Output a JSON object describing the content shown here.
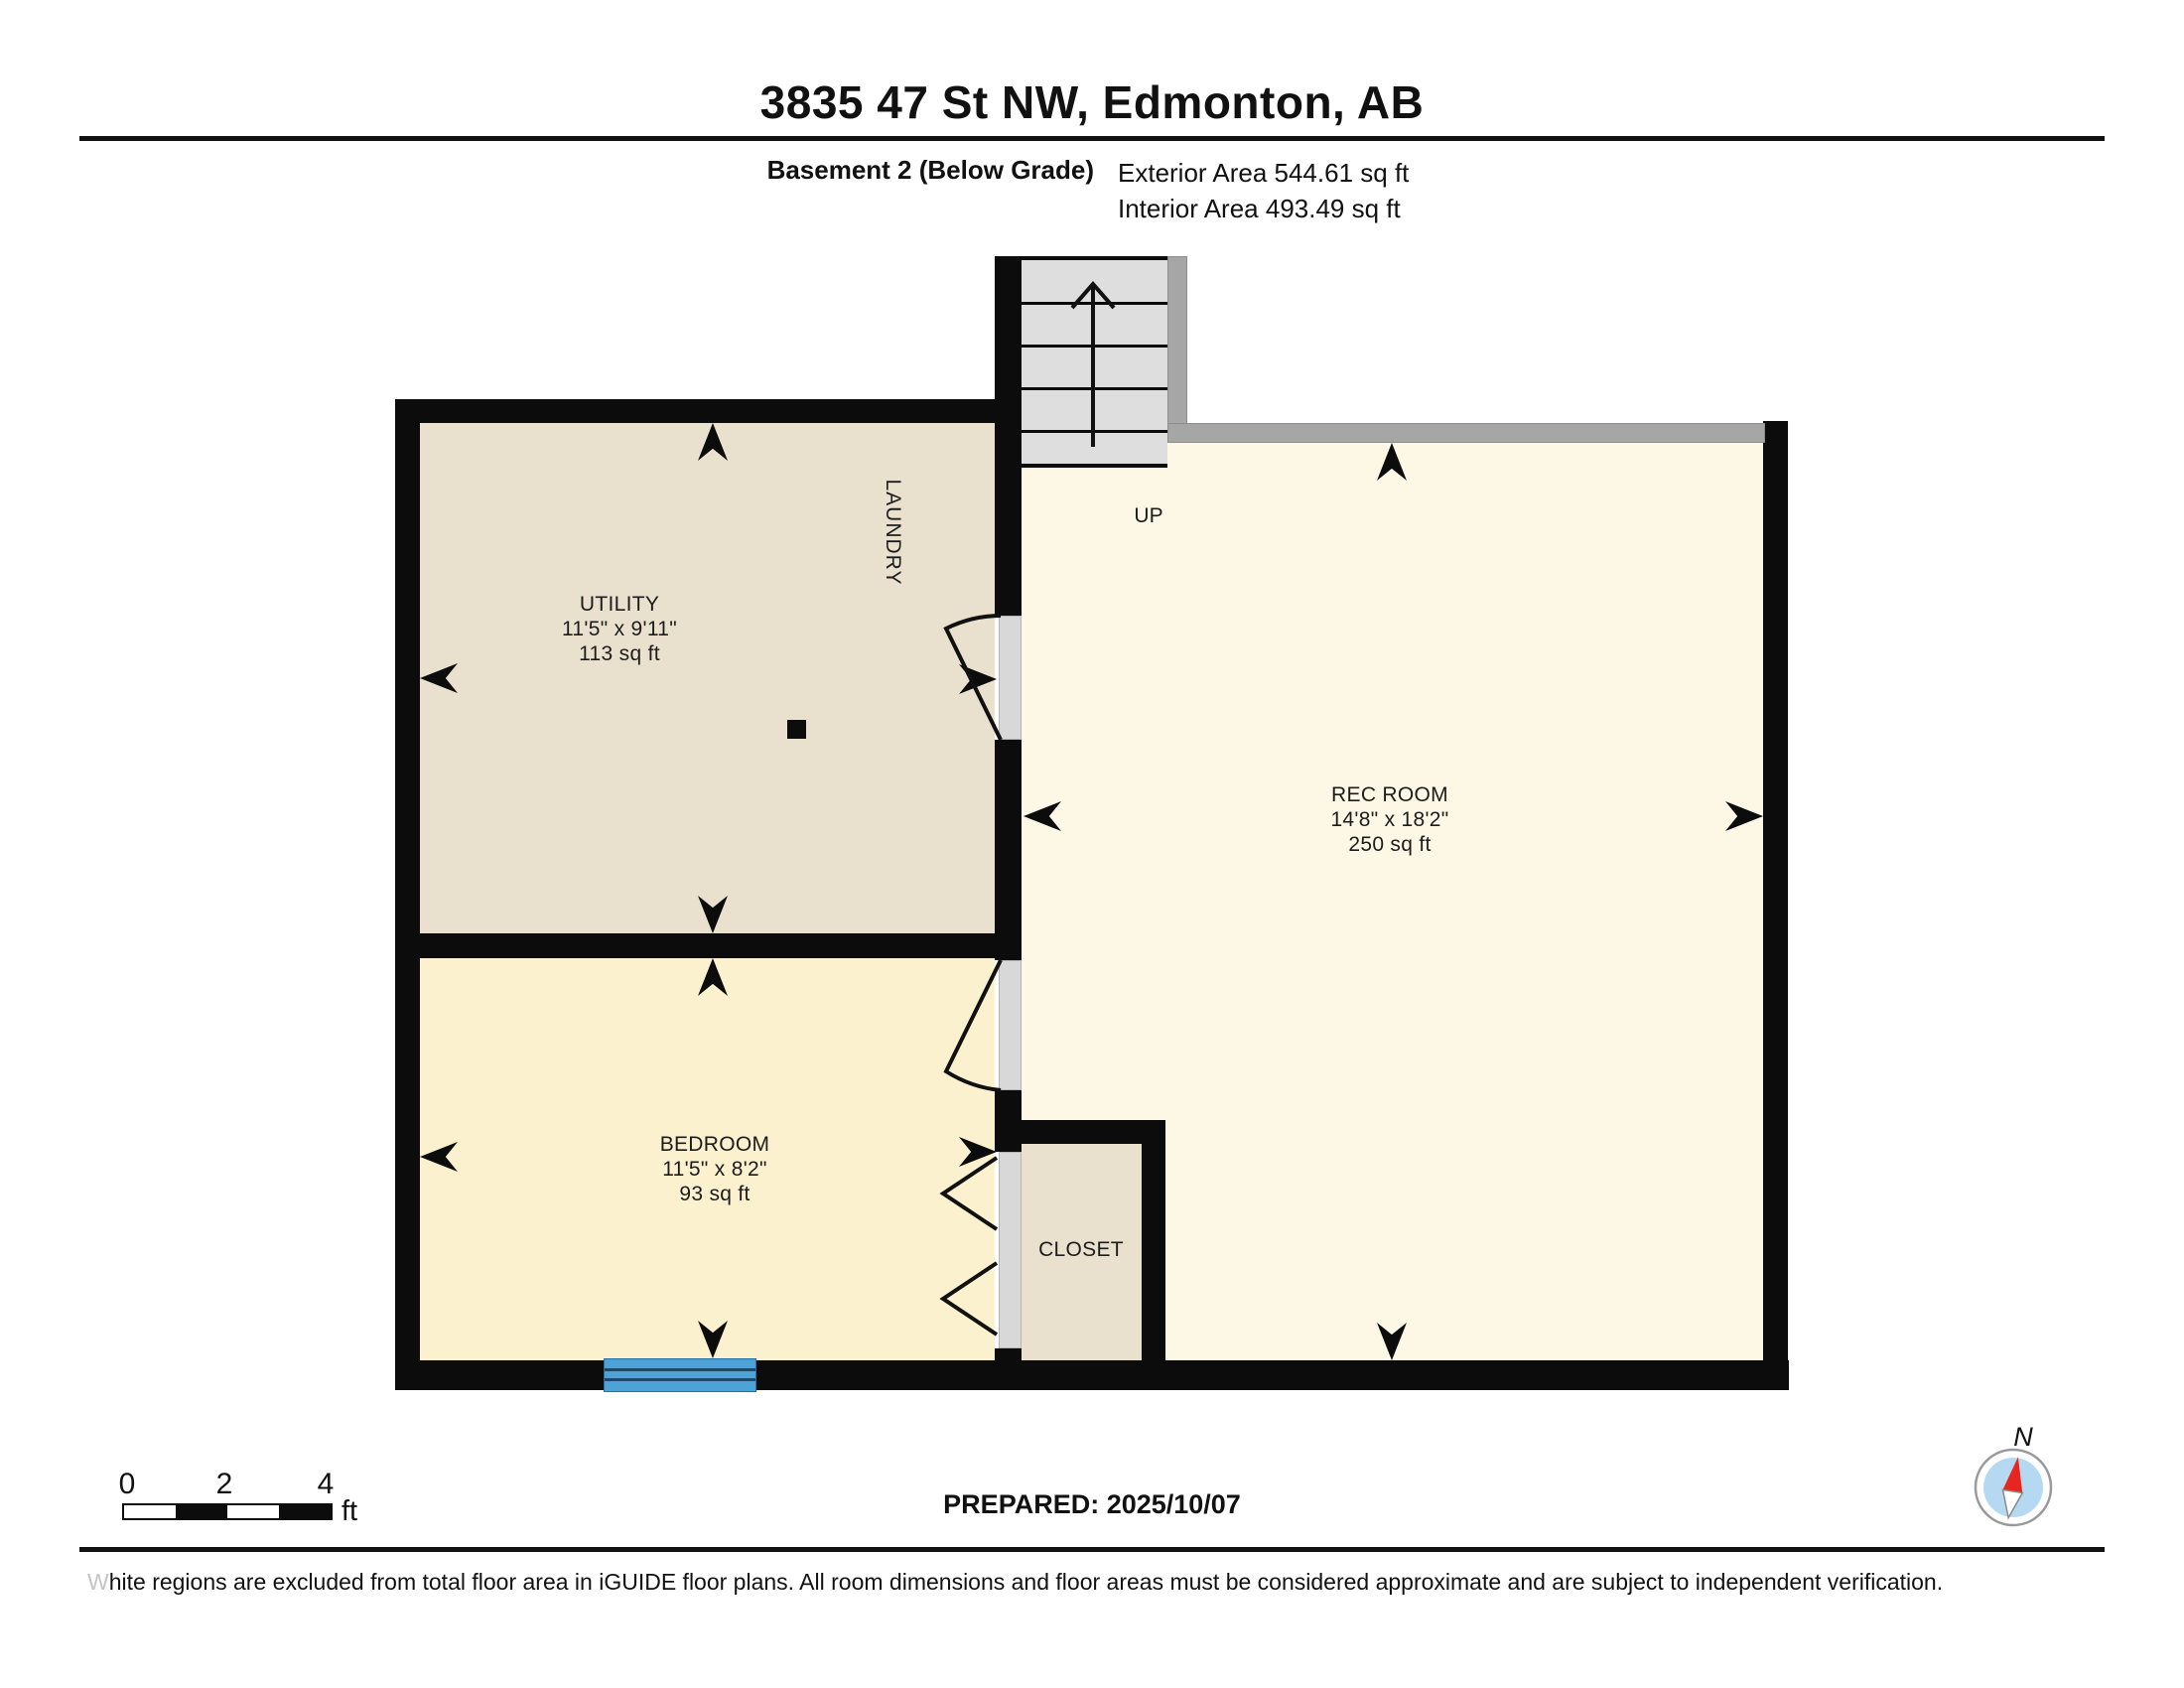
{
  "header": {
    "title": "3835 47 St NW, Edmonton, AB",
    "floor_label": "Basement 2 (Below Grade)",
    "exterior_area": "Exterior Area 544.61 sq ft",
    "interior_area": "Interior Area 493.49 sq ft"
  },
  "rooms": {
    "utility": {
      "name": "UTILITY",
      "dims": "11'5\" x 9'11\"",
      "area": "113 sq ft"
    },
    "laundry_label": "LAUNDRY",
    "stairs_label": "UP",
    "rec_room": {
      "name": "REC ROOM",
      "dims": "14'8\" x 18'2\"",
      "area": "250 sq ft"
    },
    "bedroom": {
      "name": "BEDROOM",
      "dims": "11'5\" x 8'2\"",
      "area": "93 sq ft"
    },
    "closet": {
      "name": "CLOSET"
    }
  },
  "footer": {
    "scale_ticks": [
      "0",
      "2",
      "4"
    ],
    "scale_unit": "ft",
    "prepared": "PREPARED: 2025/10/07",
    "compass_label": "N",
    "disclaimer_lead": "W",
    "disclaimer_rest": "hite regions are excluded from total floor area in iGUIDE floor plans. All room dimensions and floor areas must be considered approximate and are subject to independent verification."
  },
  "colors": {
    "wall": "#0c0c0c",
    "gray-wall": "#a6a6a6",
    "opening": "#d8d8d8",
    "stairs-fill": "#dedede",
    "utility-fill": "#e9e1ce",
    "bedroom-fill": "#fcf1cf",
    "rec-fill": "#fdf8e6",
    "window-blue": "#4da3d8",
    "window-line": "#1d4a6b",
    "compass-red": "#e8251f",
    "compass-blue": "#b5d9f1"
  }
}
